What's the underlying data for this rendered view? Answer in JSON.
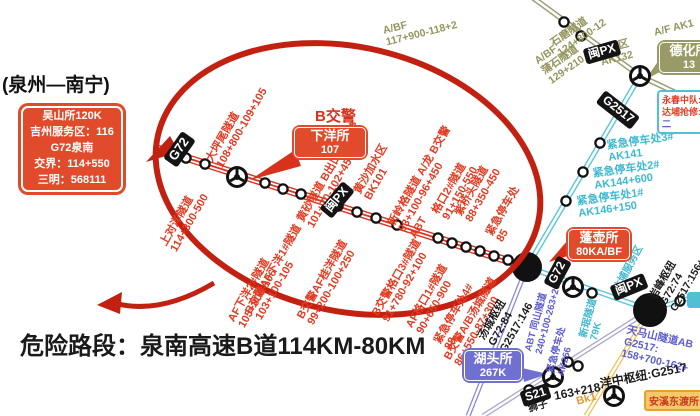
{
  "title": "(泉州—南宁)",
  "danger_text": "危险路段：泉南高速B道114KM-80KM",
  "police_label": "B交警",
  "info_box": {
    "lines": [
      "吴山所120K",
      "吉州服务区：116",
      "G72泉南",
      "交界：114+550",
      "三明：568111"
    ]
  },
  "stations": {
    "xiayang": {
      "name": "下洋所",
      "code": "107"
    },
    "penghu": {
      "name": "蓬壶所",
      "code": "80KA/BF"
    },
    "hutou": {
      "name": "湖头所",
      "code": "267K"
    },
    "dehua": {
      "name": "德化所",
      "code": "13"
    },
    "anxi": {
      "name": "安溪东渡所"
    }
  },
  "rescue_box": {
    "lines": [
      "永春中队:1",
      "达埔抢修:1",
      "二"
    ]
  },
  "badges": {
    "g72": "G72",
    "g2517": "G2517",
    "s21": "S21",
    "minpx": "闽PX"
  },
  "tunnel_labels": [
    {
      "lines": [
        "上对洋隧道",
        "114+300-500"
      ]
    },
    {
      "lines": [
        "大坪尾隧道",
        "108+800-109+105"
      ]
    },
    {
      "lines": [
        "AF下洋2#隧道",
        "105+800-106"
      ]
    },
    {
      "lines": [
        "B交警AF下洋1#隧道",
        "103+100-105"
      ]
    },
    {
      "lines": [
        "黄砂隧道 B出口 龙交警",
        "101+70-102+450"
      ]
    },
    {
      "lines": [
        "黄沙加水区",
        "BK101"
      ]
    },
    {
      "lines": [
        "B交警AF桂洋隧道",
        "99+200-100+250"
      ]
    },
    {
      "lines": [
        "新岭格隧道 A/龙 B交警",
        "93+100-96+450",
        "ABT"
      ]
    },
    {
      "lines": [
        "B交警格口3#隧道",
        "91+780-92+100"
      ]
    },
    {
      "lines": [
        "格口2#隧道",
        "91+150-550"
      ]
    },
    {
      "lines": [
        "AF格口1#隧道",
        "90+650-900"
      ]
    },
    {
      "lines": [
        "紧急停车处4#",
        "88"
      ]
    },
    {
      "lines": [
        "紫桥头隧道",
        "88+350-450"
      ]
    },
    {
      "lines": [
        "B交警A/B汤城隧道",
        "86+550-87+300"
      ]
    },
    {
      "lines": [
        "紧急停车处",
        "85"
      ]
    }
  ],
  "cyan_labels": [
    {
      "lines": [
        "紧急停车处3#",
        "AK141"
      ]
    },
    {
      "lines": [
        "紧急停车处2#",
        "AK144+600"
      ]
    },
    {
      "lines": [
        "紧急停车处1#",
        "AK146+150"
      ]
    },
    {
      "lines": [
        "达埔服务区",
        "76K"
      ]
    },
    {
      "lines": [
        "新珉隧道",
        "79K"
      ]
    }
  ],
  "olive_labels": [
    {
      "lines": [
        "A/BF",
        "117+900-118+2"
      ]
    },
    {
      "lines": [
        "石磨隧道",
        "124+800-12"
      ]
    },
    {
      "lines": [
        "A/BF",
        "蒲石隧道",
        "129+210"
      ]
    },
    {
      "lines": [
        "加水区",
        "AK132"
      ]
    },
    {
      "lines": [
        "A/F AK1"
      ]
    }
  ],
  "purple_labels": [
    {
      "lines": [
        "ABT 同山隧道",
        "240+100-263+200"
      ]
    },
    {
      "lines": [
        "紧急停车处",
        "AK266"
      ]
    },
    {
      "lines": [
        "天马山隧道AB",
        "G2517:",
        "158+700-162+"
      ]
    }
  ],
  "black_labels": [
    {
      "lines": [
        "汤城枢纽",
        "G72:84",
        "G2517:146"
      ]
    },
    {
      "lines": [
        "岩峰枢纽",
        "G72:74",
        "G2517:156+"
      ]
    },
    {
      "lines": [
        "洋中枢纽:G2517"
      ]
    },
    {
      "lines": [
        "163+218"
      ]
    },
    {
      "lines": [
        "狮子"
      ]
    }
  ],
  "orange_labels": [
    {
      "lines": [
        "Bk1"
      ]
    }
  ],
  "colors": {
    "accent_red": "#d8311c",
    "circle_red": "#c22010",
    "cyan": "#3fb9cf",
    "olive": "#94945e",
    "purple": "#5d5dcd",
    "yellow": "#eec253",
    "orange": "#e8a030"
  }
}
